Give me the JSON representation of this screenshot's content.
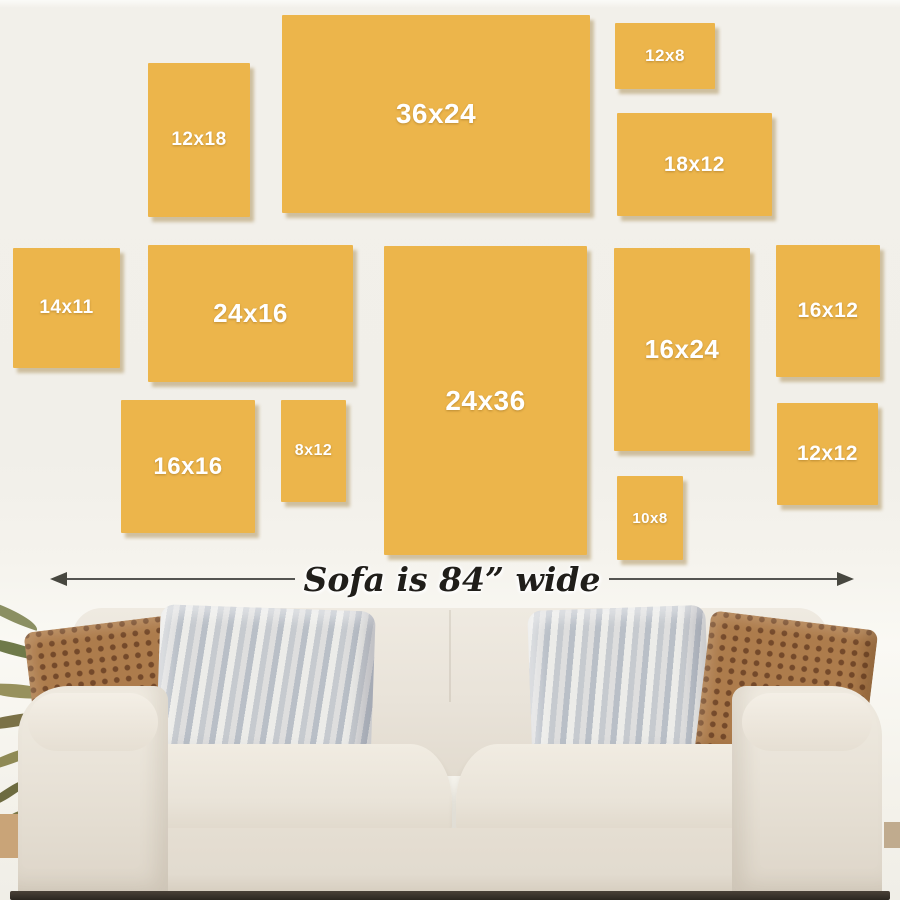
{
  "palette": {
    "wall": "#f1efe9",
    "frame_fill": "#ecb54b",
    "frame_shadow": "rgba(148,111,38,0.38)",
    "frame_label_text": "#ffffff",
    "annotation_text": "#201e1a",
    "arrow_line": "#545451",
    "sofa_fabric": "#e9e3d9",
    "pillow_brown": "#ad7c4c",
    "pillow_stripe_gray": "#c6cacf"
  },
  "frames": [
    {
      "label": "12x18",
      "x": 148,
      "y": 63,
      "w": 102,
      "h": 154,
      "fs": 19
    },
    {
      "label": "36x24",
      "x": 282,
      "y": 15,
      "w": 308,
      "h": 198,
      "fs": 28
    },
    {
      "label": "12x8",
      "x": 615,
      "y": 23,
      "w": 100,
      "h": 66,
      "fs": 17
    },
    {
      "label": "18x12",
      "x": 617,
      "y": 113,
      "w": 155,
      "h": 103,
      "fs": 21
    },
    {
      "label": "14x11",
      "x": 13,
      "y": 248,
      "w": 107,
      "h": 120,
      "fs": 19
    },
    {
      "label": "24x16",
      "x": 148,
      "y": 245,
      "w": 205,
      "h": 137,
      "fs": 26
    },
    {
      "label": "24x36",
      "x": 384,
      "y": 246,
      "w": 203,
      "h": 309,
      "fs": 28
    },
    {
      "label": "16x24",
      "x": 614,
      "y": 248,
      "w": 136,
      "h": 203,
      "fs": 26
    },
    {
      "label": "16x12",
      "x": 776,
      "y": 245,
      "w": 104,
      "h": 132,
      "fs": 21
    },
    {
      "label": "16x16",
      "x": 121,
      "y": 400,
      "w": 134,
      "h": 133,
      "fs": 24
    },
    {
      "label": "8x12",
      "x": 281,
      "y": 400,
      "w": 65,
      "h": 102,
      "fs": 16
    },
    {
      "label": "10x8",
      "x": 617,
      "y": 476,
      "w": 66,
      "h": 84,
      "fs": 15
    },
    {
      "label": "12x12",
      "x": 777,
      "y": 403,
      "w": 101,
      "h": 102,
      "fs": 21
    }
  ],
  "annotation": {
    "text": "Sofa is 84” wide"
  },
  "leaves": [
    {
      "x": -20,
      "y": 598,
      "w": 62,
      "h": 14,
      "rot": 18,
      "color": "#8b8f62"
    },
    {
      "x": -24,
      "y": 636,
      "w": 78,
      "h": 16,
      "rot": 8,
      "color": "#6f7a4a"
    },
    {
      "x": -18,
      "y": 684,
      "w": 72,
      "h": 18,
      "rot": -3,
      "color": "#97915d"
    },
    {
      "x": -24,
      "y": 724,
      "w": 82,
      "h": 16,
      "rot": -16,
      "color": "#7a7147"
    },
    {
      "x": -16,
      "y": 766,
      "w": 64,
      "h": 14,
      "rot": -28,
      "color": "#8f8a55"
    },
    {
      "x": -12,
      "y": 804,
      "w": 54,
      "h": 12,
      "rot": -40,
      "color": "#6d6b40"
    },
    {
      "x": -10,
      "y": 838,
      "w": 44,
      "h": 11,
      "rot": -52,
      "color": "#7c7848"
    }
  ]
}
